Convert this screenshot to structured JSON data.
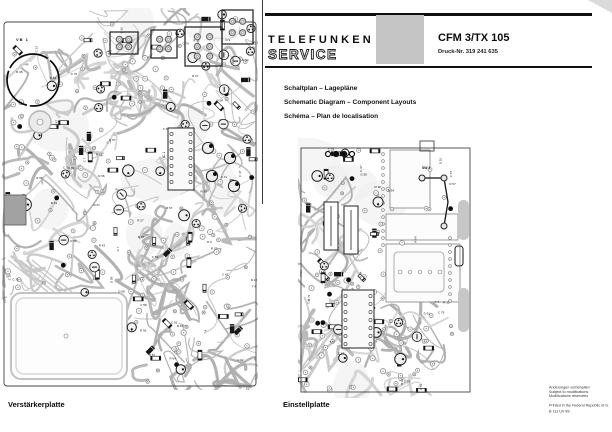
{
  "header": {
    "brand_line1": "TELEFUNKEN",
    "brand_line2": "SERVICE",
    "model": "CFM 3/TX 105",
    "print_no": "Druck-Nr. 319 241 635"
  },
  "titles": {
    "line_de": "Schaltplan – Lagepläne",
    "line_en": "Schematic Diagram – Component Layouts",
    "line_fr": "Schéma – Plan de localisation"
  },
  "boards": {
    "left_caption": "Verstärkerplatte",
    "right_caption": "Einstellplatte"
  },
  "board_markers": {
    "vb1": "VB 1",
    "sw1": "SW 1",
    "ic1": "IC 1"
  },
  "component_labels": [
    "C 44",
    "C 47",
    "C 55",
    "C 58",
    "C 67",
    "C 71",
    "C 79",
    "R 27",
    "R 38",
    "R 43",
    "R 56",
    "R 57",
    "R 58",
    "R 64",
    "R 66",
    "D 51",
    "D 52",
    "D 58",
    "T 4",
    "T 7",
    "C 23",
    "R 12",
    "C 7",
    "D 9",
    "T 2",
    "C 62",
    "R 49",
    "C 37"
  ],
  "footer": {
    "note_de": "Änderungen vorbehalten",
    "note_en": "Subject to modifications",
    "note_fr": "Modifications réservées",
    "printed": "Printed in the Federal Republic of G.",
    "code": "B 111 UV 89"
  },
  "colors": {
    "rule": "#101010",
    "gray_square": "#c5c5c5",
    "trace_light": "#c9c9c9",
    "trace_mid": "#b6b6b6",
    "board_outline": "#454545",
    "component_dark": "#1a1a1a"
  }
}
